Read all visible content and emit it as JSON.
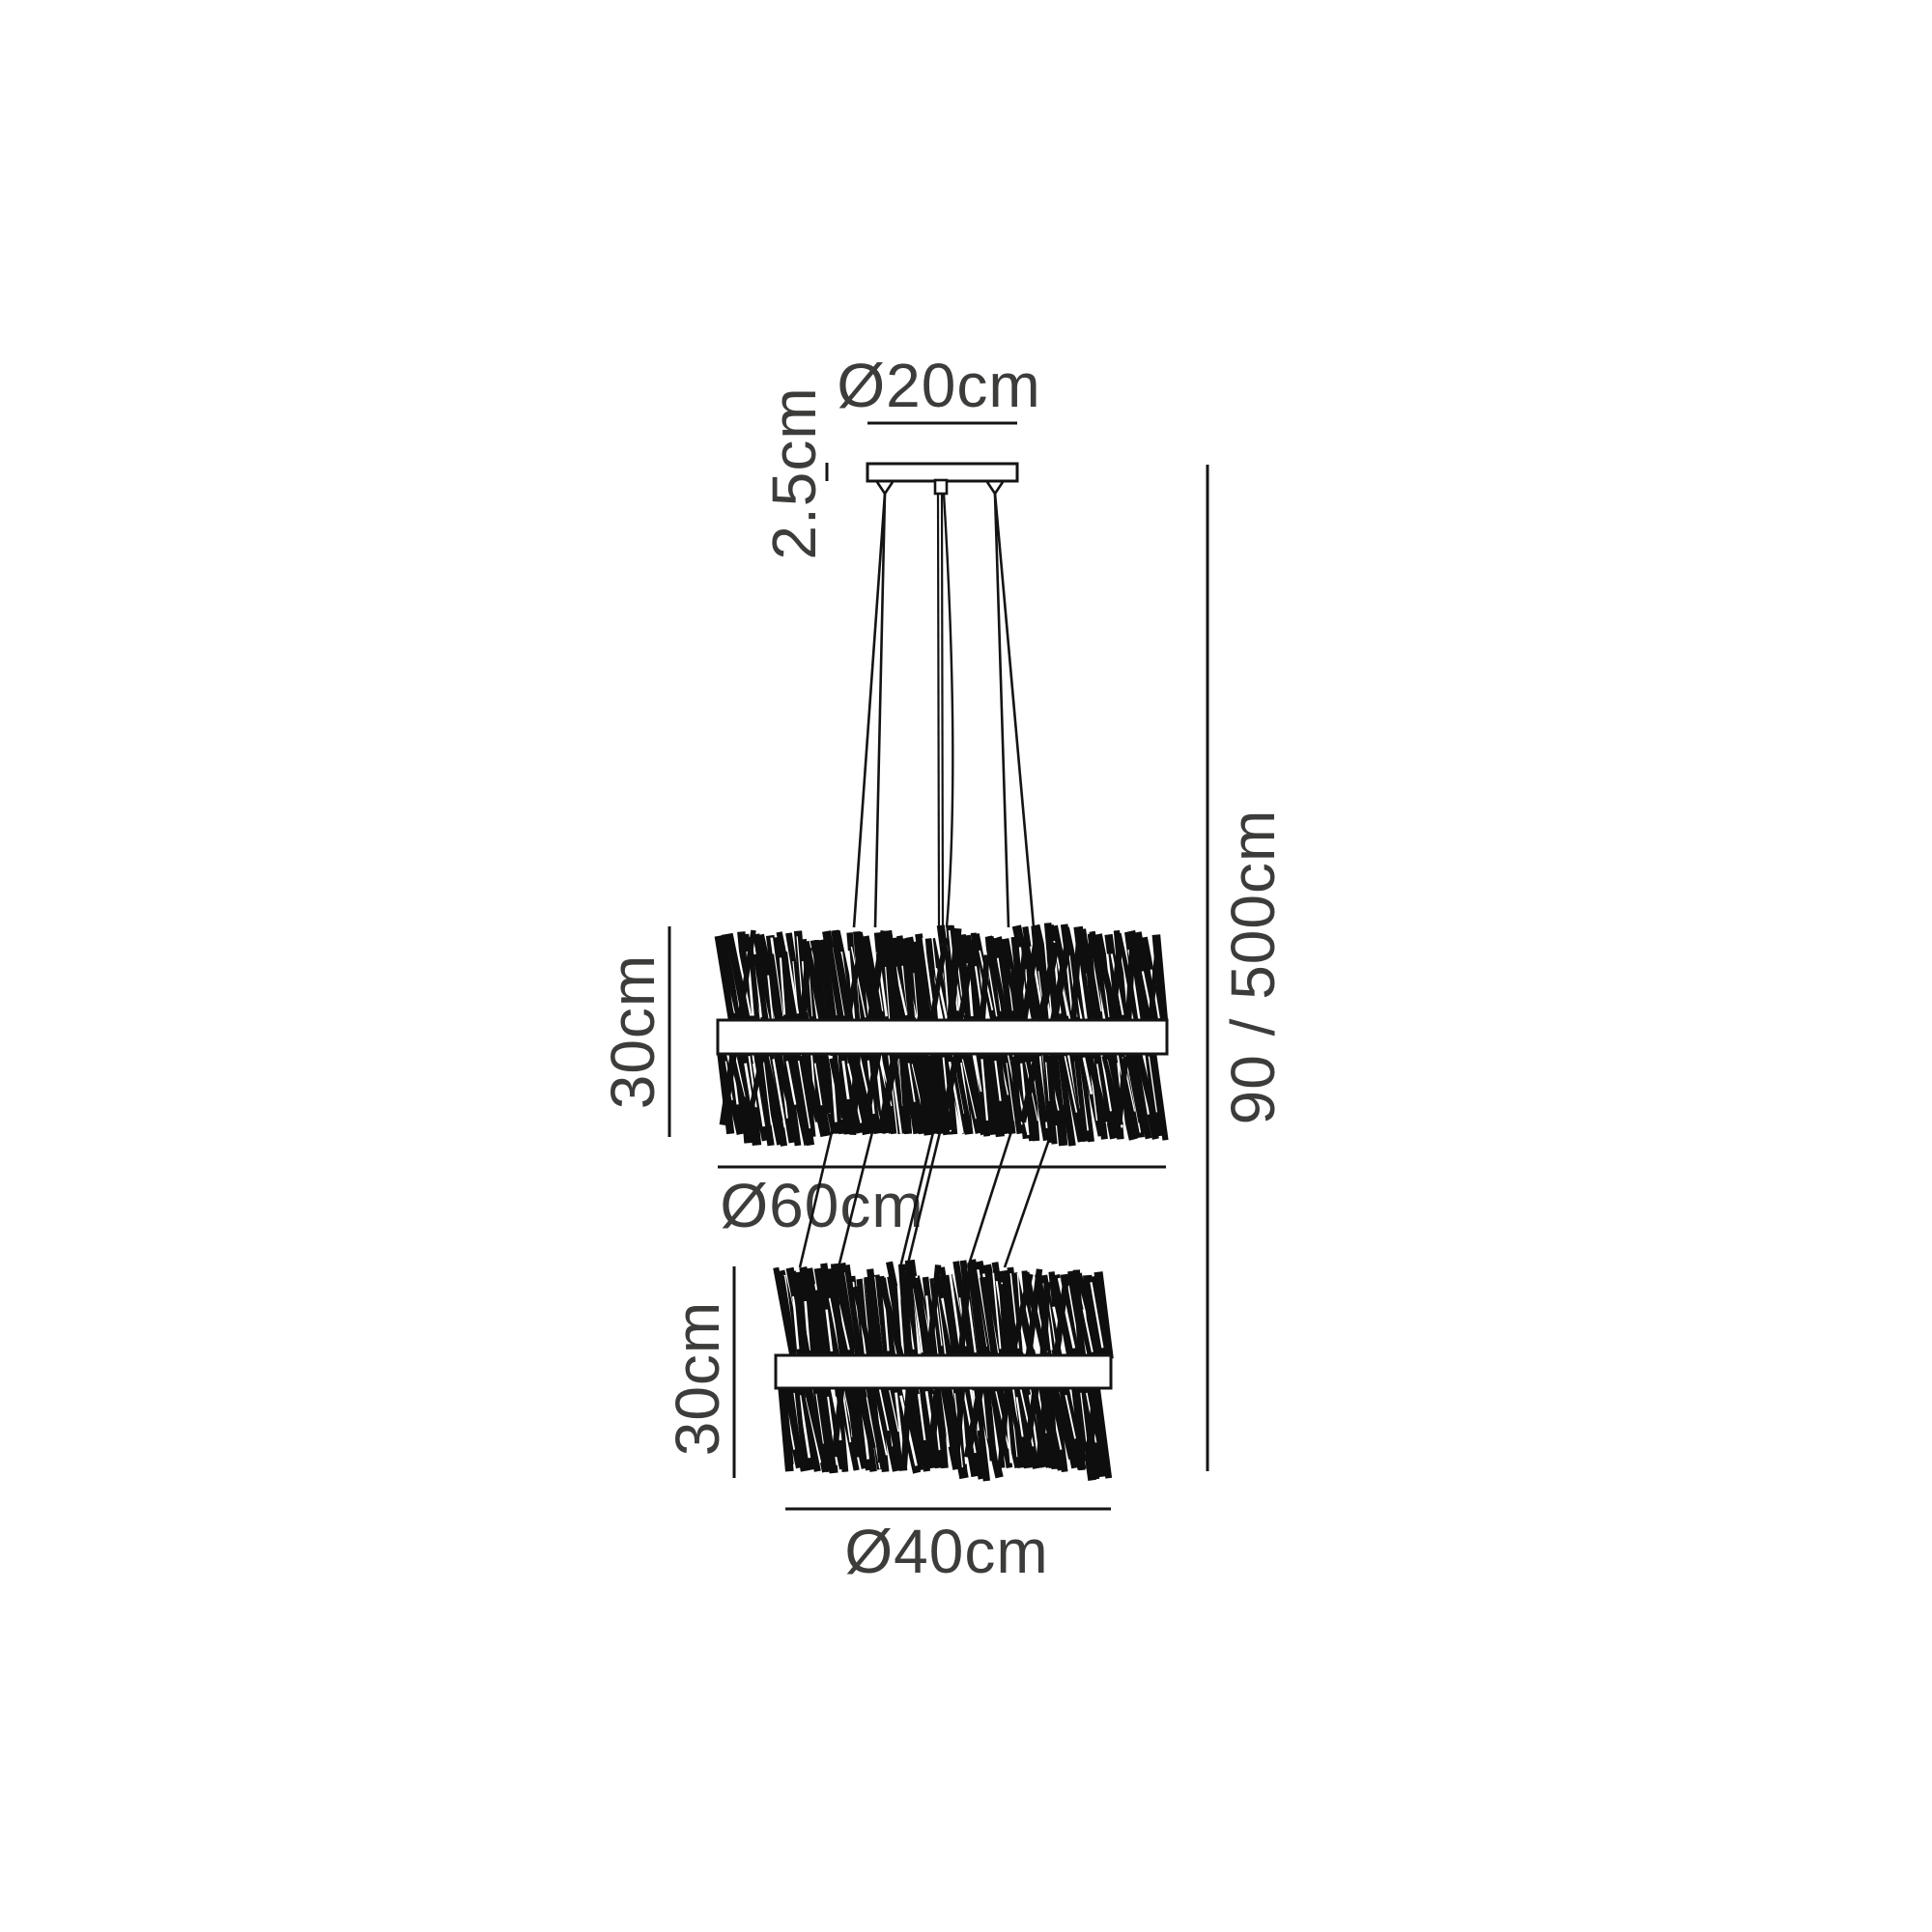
{
  "diagram": {
    "title": "pendant-chandelier-dimension-drawing",
    "canopy": {
      "diameter_label": "Ø20cm",
      "height_label": "2.5cm"
    },
    "upper_shade": {
      "height_label": "30cm",
      "diameter_label": "Ø60cm"
    },
    "lower_shade": {
      "height_label": "30cm",
      "diameter_label": "Ø40cm"
    },
    "overall": {
      "drop_label": "90 / 500cm"
    }
  },
  "colors": {
    "background": "#ffffff",
    "line": "#141414",
    "text": "#3c3c3b"
  }
}
